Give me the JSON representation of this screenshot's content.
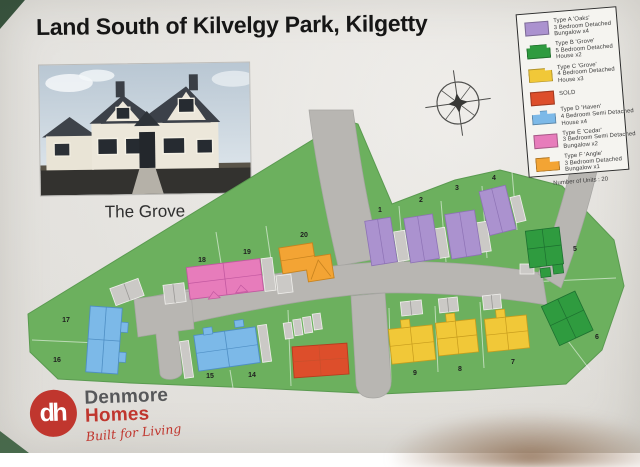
{
  "page": {
    "title": "Land South of Kilvelgy Park, Kilgetty"
  },
  "photo": {
    "caption": "The Grove"
  },
  "legend": {
    "entries": [
      {
        "name": "type-a",
        "lines": [
          "Type A 'Oaks'",
          "3 Bedroom Detached",
          "Bungalow x4"
        ]
      },
      {
        "name": "type-b",
        "lines": [
          "Type B 'Grove'",
          "5 Bedroom Detached",
          "House x2"
        ]
      },
      {
        "name": "type-c",
        "lines": [
          "Type C 'Grove'",
          "4 Bedroom Detached",
          "House x3"
        ]
      },
      {
        "name": "sold",
        "lines": [
          "SOLD"
        ]
      },
      {
        "name": "type-d",
        "lines": [
          "Type D 'Haven'",
          "4 Bedroom Semi Detached",
          "House x4"
        ]
      },
      {
        "name": "type-e",
        "lines": [
          "Type E 'Cedar'",
          "3 Bedroom Semi Detached",
          "Bungalow x2"
        ]
      },
      {
        "name": "type-f",
        "lines": [
          "Type F 'Angle'",
          "3 Bedroom Detached",
          "Bungalow x1"
        ]
      }
    ],
    "footer": "Number of Units : 20"
  },
  "plan": {
    "plot_numbers": [
      "1",
      "2",
      "3",
      "4",
      "5",
      "6",
      "7",
      "8",
      "9",
      "14",
      "15",
      "16",
      "17",
      "18",
      "19",
      "20"
    ]
  },
  "logo": {
    "monogram": "dh",
    "name_top": "Denmore",
    "name_bottom": "Homes",
    "tagline": "Built for Living"
  },
  "colors": {
    "backdrop": "#44614 8",
    "title_ink": "#161616",
    "land": "#6cb05e",
    "road": "#b8b6b2",
    "purple": "#ab92cf",
    "green": "#2f9b3f",
    "yellow": "#f1c838",
    "red": "#dd4e2b",
    "blue": "#7cb9e8",
    "pink": "#e77cbb",
    "orange": "#f3a434",
    "gray_building": "#cbc9c6",
    "logo_red": "#c0362e",
    "logo_gray": "#57585a"
  }
}
